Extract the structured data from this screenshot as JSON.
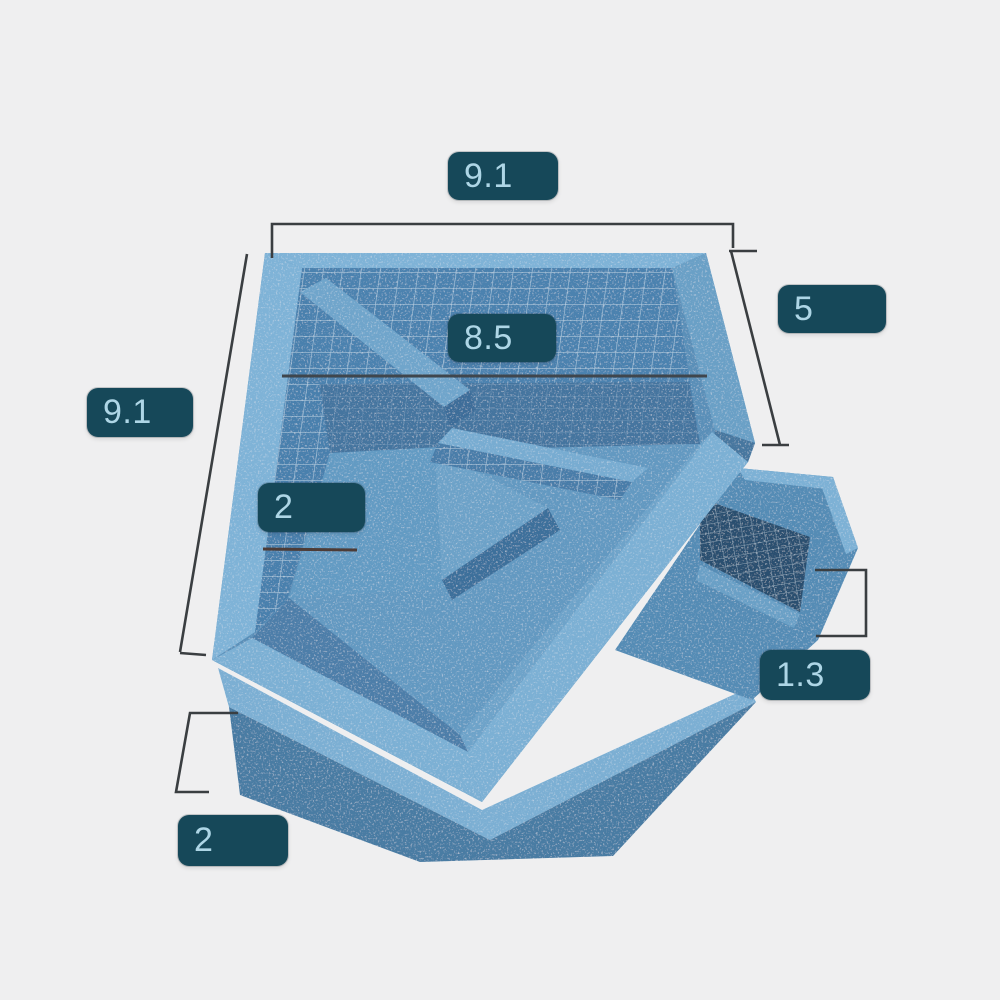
{
  "diagram": {
    "type": "dimensioned-3d-diagram",
    "colors": {
      "background": "#efeff0",
      "label_background": "#164859",
      "label_text": "#aed6e6",
      "foam_light": "#7fb3d7",
      "foam_medium": "#558cb5",
      "foam_shadow": "#3e6f9b",
      "interior_wall": "#4c82af",
      "basin_interior_dark": "#2b4f6f",
      "mesh_line": "#ffffff",
      "dimension_line": "#3a3e41"
    },
    "dimensions": [
      {
        "name": "top-width",
        "value": "9.1"
      },
      {
        "name": "left-side",
        "value": "9.1"
      },
      {
        "name": "inner-width",
        "value": "8.5"
      },
      {
        "name": "right-side",
        "value": "5"
      },
      {
        "name": "inner-step-width",
        "value": "2"
      },
      {
        "name": "right-wall-height",
        "value": "1.3"
      },
      {
        "name": "base-height",
        "value": "2"
      }
    ]
  }
}
